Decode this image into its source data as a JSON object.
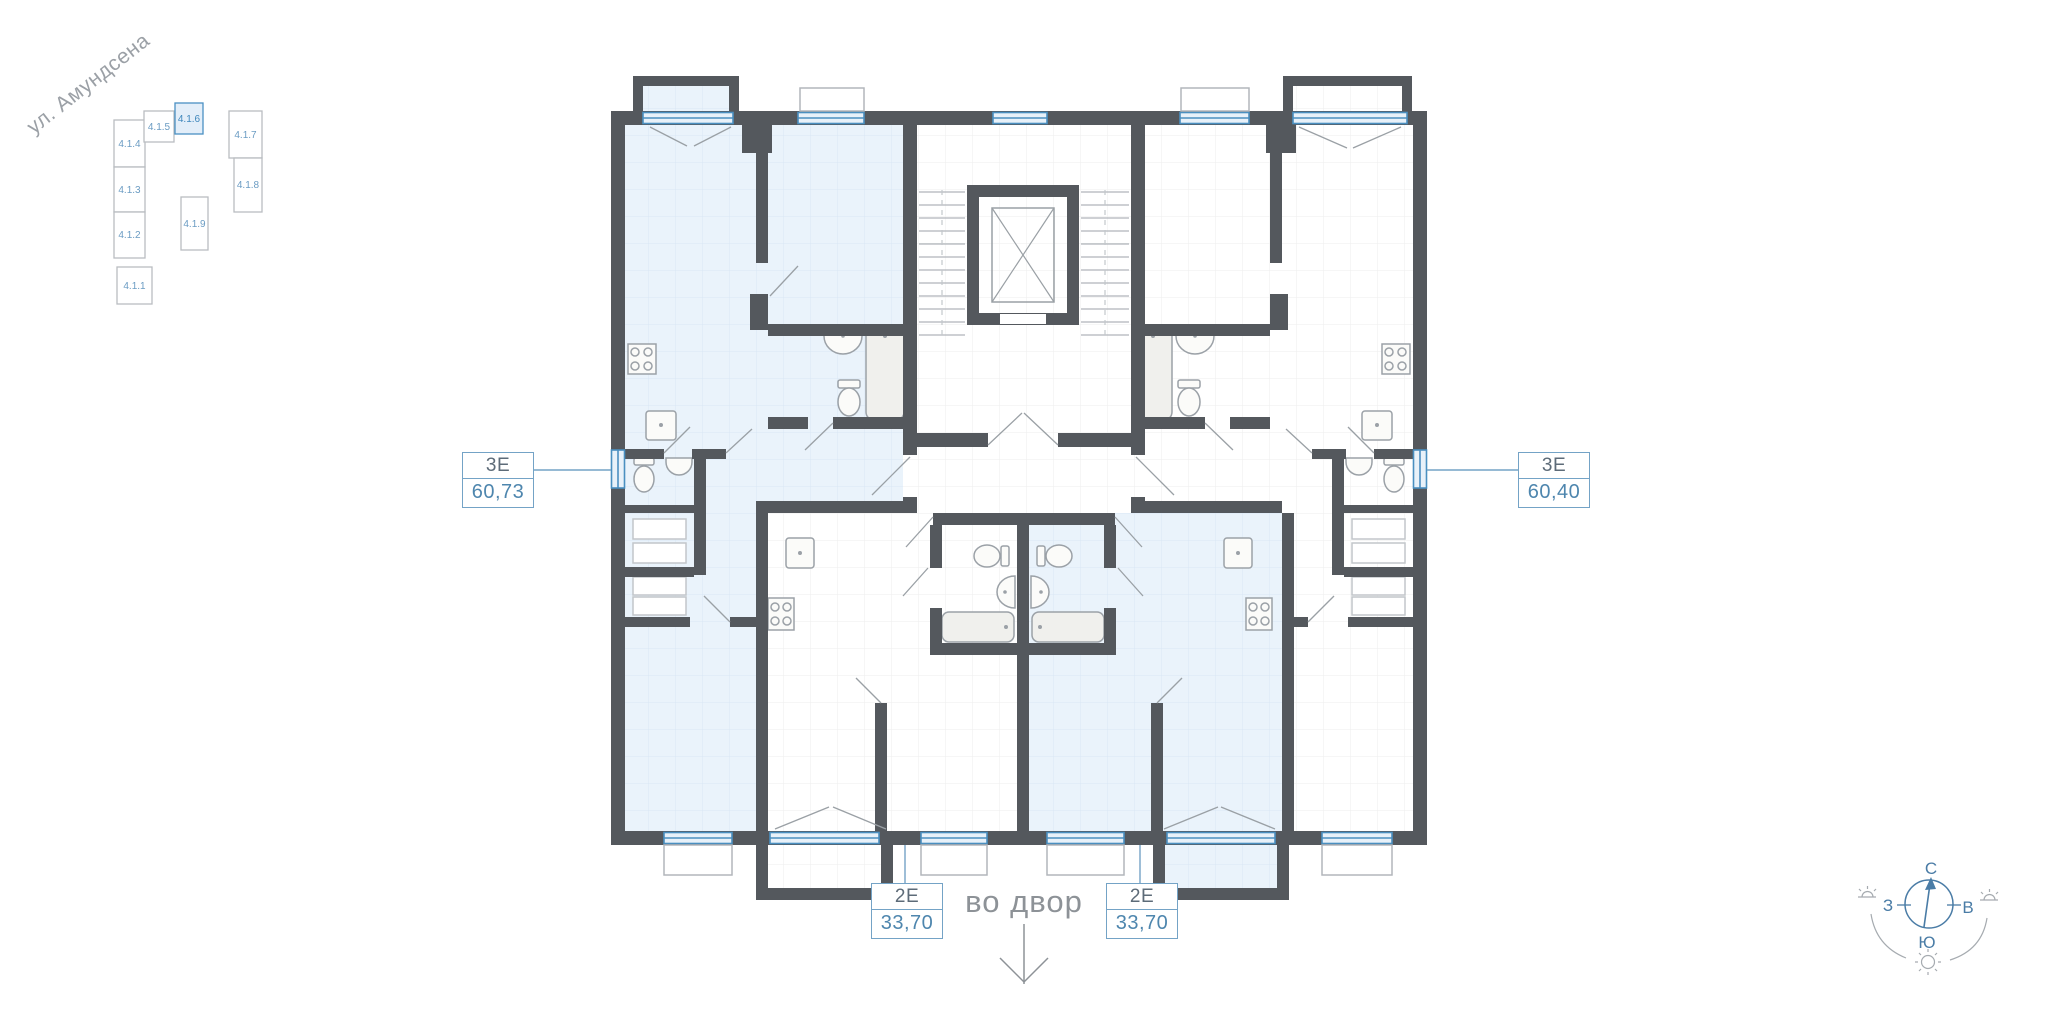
{
  "minimap": {
    "street_label": "ул. Амундсена",
    "buildings": [
      {
        "label": "4.1.4",
        "highlighted": false
      },
      {
        "label": "4.1.5",
        "highlighted": false
      },
      {
        "label": "4.1.6",
        "highlighted": true
      },
      {
        "label": "4.1.7",
        "highlighted": false
      },
      {
        "label": "4.1.8",
        "highlighted": false
      },
      {
        "label": "4.1.3",
        "highlighted": false
      },
      {
        "label": "4.1.2",
        "highlighted": false
      },
      {
        "label": "4.1.1",
        "highlighted": false
      },
      {
        "label": "4.1.9",
        "highlighted": false
      }
    ]
  },
  "apartments": [
    {
      "id": "left-3e",
      "type": "3Е",
      "area": "60,73",
      "highlighted": true
    },
    {
      "id": "right-3e",
      "type": "3Е",
      "area": "60,40",
      "highlighted": false
    },
    {
      "id": "bottom-left-2e",
      "type": "2Е",
      "area": "33,70",
      "highlighted": false
    },
    {
      "id": "bottom-right-2e",
      "type": "2Е",
      "area": "33,70",
      "highlighted": true
    }
  ],
  "courtyard": {
    "label": "во двор"
  },
  "compass": {
    "north": "С",
    "south": "Ю",
    "west": "З",
    "east": "В"
  },
  "colors": {
    "wall": "#54585d",
    "apartment_highlight": "#eaf3fb",
    "window_accent": "#4a8fc0",
    "label_accent": "#4e86ae",
    "muted_text": "#8d9297"
  }
}
